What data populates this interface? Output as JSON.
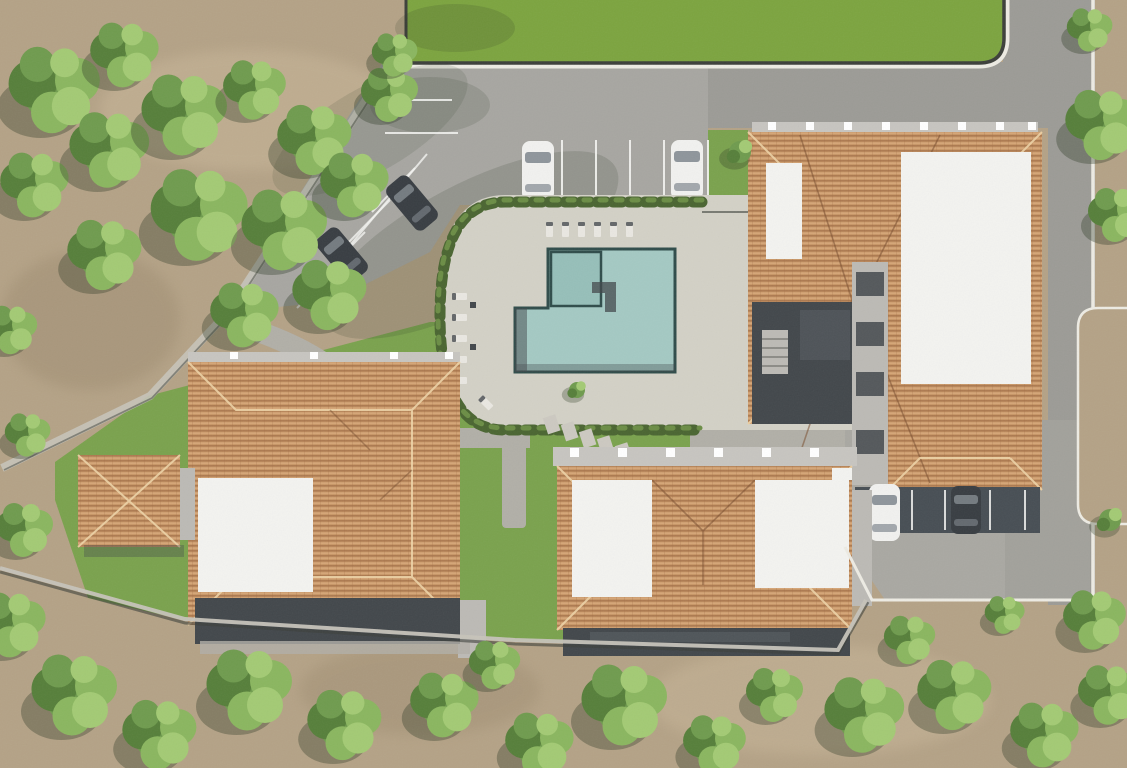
{
  "scene": {
    "kind": "architectural-3d-render",
    "view": "top-down aerial site plan",
    "description": "Residential complex render seen from directly above: four large buildings with terracotta hipped roofs and white flat roof sections, one small outbuilding, central swimming pool with paved deck and hedge border, parking lot with cars, perimeter road along a green lawn, surrounded by bare earth and trees.",
    "colors": {
      "dirt": "#b4a286",
      "dirt_light": "#c7b598",
      "dirt_dark": "#9d8b6f",
      "lawn": "#7ca43f",
      "grass": "#7aa24d",
      "road": "#9c9b96",
      "parking": "#a7a6a1",
      "deck": "#d3d1c6",
      "path": "#b1afa7",
      "lot_right": "#a9a8a2",
      "lot_dark": "#474e54",
      "curb": "#edebe3",
      "wall_dark": "#3c3f3a",
      "wall_light": "#c6c3b9",
      "pool_water": "#a4c9c3",
      "pool_kids": "#96bfb9",
      "pool_edge": "#2f4c4a",
      "roof_base": "#c89767",
      "roof_stripe": "#9e6a43",
      "roof_stripe2": "#e0b183",
      "roof_ridge": "#edd3a6",
      "roof_valley": "#7a4f30",
      "flat_roof": "#f3f3f0",
      "parapet": "#c7c5c0",
      "concrete": "#bcbab5",
      "facade": "#42474b",
      "facade2": "#565b60",
      "hedge": "#4a6531",
      "hedge2": "#6b8d45",
      "tree1": "#6f9b4e",
      "tree2": "#8ab65f",
      "tree3": "#567f3a",
      "tree4": "#a3ca74",
      "tree_shadow": "#2d3a25",
      "car_white": "#f1f1ef",
      "car_dark": "#383d42",
      "glass": "#8e959b",
      "stall_line": "#f5f5f2",
      "lounger": "#e9e7e1",
      "stepping_stone": "#ccc9c1"
    },
    "inventory": {
      "buildings": 5,
      "swimming_pools": 1,
      "cars": 6,
      "sun_loungers": 12,
      "parking_areas": 2
    }
  }
}
